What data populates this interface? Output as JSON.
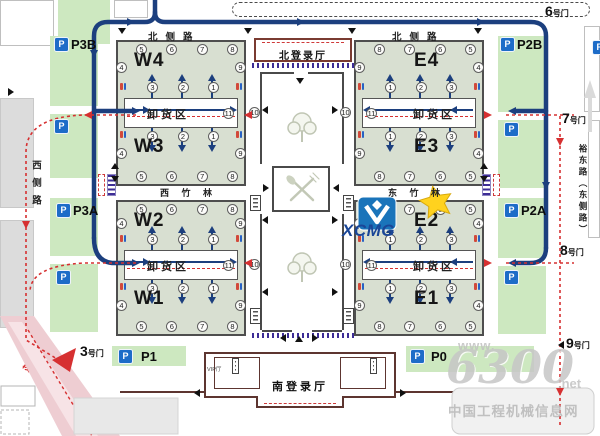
{
  "map": {
    "roads": {
      "north": "北侧路",
      "west": "西侧路",
      "east": "裕东路（东侧路）",
      "pink_section": "路段"
    },
    "gates": {
      "g6": {
        "num": "6",
        "suffix": "号门"
      },
      "g7": {
        "num": "7",
        "suffix": "号门"
      },
      "g8": {
        "num": "8",
        "suffix": "号门"
      },
      "g9": {
        "num": "9",
        "suffix": "号门"
      },
      "g3": {
        "num": "3",
        "suffix": "号门"
      }
    },
    "parking": {
      "p_letter": "P",
      "p3b": "P3B",
      "p3a": "P3A",
      "p2b": "P2B",
      "p2a": "P2A",
      "p1": "P1",
      "p0": "P0"
    },
    "labels": {
      "unload": "卸货区",
      "north_hall": "北登录厅",
      "south_hall": "南登录厅",
      "vip": "VIP厅",
      "west_bamboo": "西 竹 林",
      "east_bamboo": "东 竹 林"
    },
    "logo": {
      "text": "XCMG"
    },
    "watermark": {
      "www": "www.",
      "big": "6300",
      "net": ".net",
      "site": "中国工程机械信息网"
    },
    "quadrants": [
      {
        "id": "nw",
        "hall_top": "W4",
        "hall_bottom": "W3",
        "top_row": [
          "5",
          "6",
          "7",
          "8"
        ],
        "bottom_row": [
          "5",
          "6",
          "7",
          "8"
        ],
        "inner_top": [
          "3",
          "2",
          "1"
        ],
        "inner_bottom": [
          "3",
          "2",
          "1"
        ],
        "left_top": "4",
        "left_bottom": "4",
        "right_top": "9",
        "right_bottom": "9",
        "strip_end": "11",
        "corridor_num": "10"
      },
      {
        "id": "ne",
        "hall_top": "E4",
        "hall_bottom": "E3",
        "top_row": [
          "8",
          "7",
          "6",
          "5"
        ],
        "bottom_row": [
          "8",
          "7",
          "6",
          "5"
        ],
        "inner_top": [
          "1",
          "2",
          "3"
        ],
        "inner_bottom": [
          "1",
          "2",
          "3"
        ],
        "left_top": "9",
        "left_bottom": "9",
        "right_top": "4",
        "right_bottom": "4",
        "strip_end": "11",
        "corridor_num": "10"
      },
      {
        "id": "sw",
        "hall_top": "W2",
        "hall_bottom": "W1",
        "top_row": [
          "5",
          "6",
          "7",
          "8"
        ],
        "bottom_row": [
          "5",
          "6",
          "7",
          "8"
        ],
        "inner_top": [
          "3",
          "2",
          "1"
        ],
        "inner_bottom": [
          "3",
          "2",
          "1"
        ],
        "left_top": "4",
        "left_bottom": "4",
        "right_top": "9",
        "right_bottom": "9",
        "strip_end": "11",
        "corridor_num": "10"
      },
      {
        "id": "se",
        "hall_top": "E2",
        "hall_bottom": "E1",
        "top_row": [
          "8",
          "7",
          "6",
          "5"
        ],
        "bottom_row": [
          "8",
          "7",
          "6",
          "5"
        ],
        "inner_top": [
          "1",
          "2",
          "3"
        ],
        "inner_bottom": [
          "1",
          "2",
          "3"
        ],
        "left_top": "9",
        "left_bottom": "9",
        "right_top": "4",
        "right_bottom": "4",
        "strip_end": "11",
        "corridor_num": "10"
      }
    ]
  }
}
